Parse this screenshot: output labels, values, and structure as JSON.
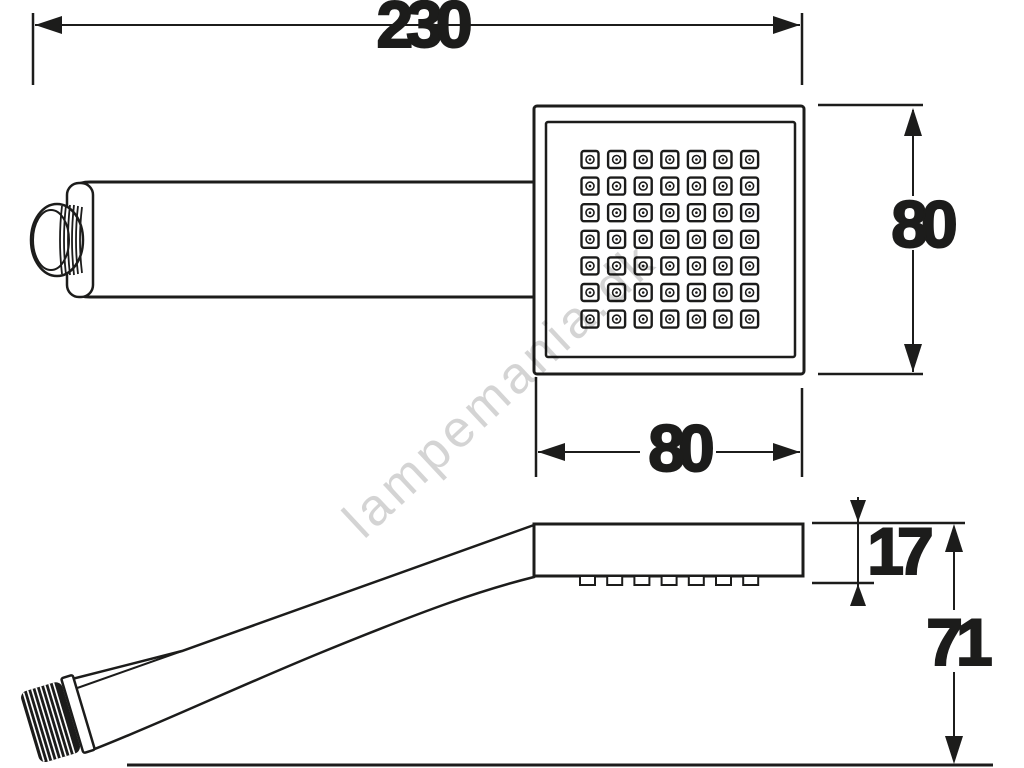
{
  "drawing": {
    "type": "shower-handset technical drawing",
    "dimensions": {
      "total_length": {
        "label": "230"
      },
      "head_height": {
        "label": "80"
      },
      "head_width": {
        "label": "80"
      },
      "head_thickness": {
        "label": "17"
      },
      "handle_end_height": {
        "label": "71"
      }
    },
    "views": {
      "top": {
        "nozzle_grid": {
          "rows": 7,
          "cols": 7
        }
      },
      "side": {
        "nozzle_count": 7
      }
    },
    "colors": {
      "line": "#1c1c1b",
      "background": "#ffffff",
      "watermark": "rgba(0,0,0,0.17)"
    }
  },
  "watermark": {
    "text": "lampemania.dk"
  }
}
